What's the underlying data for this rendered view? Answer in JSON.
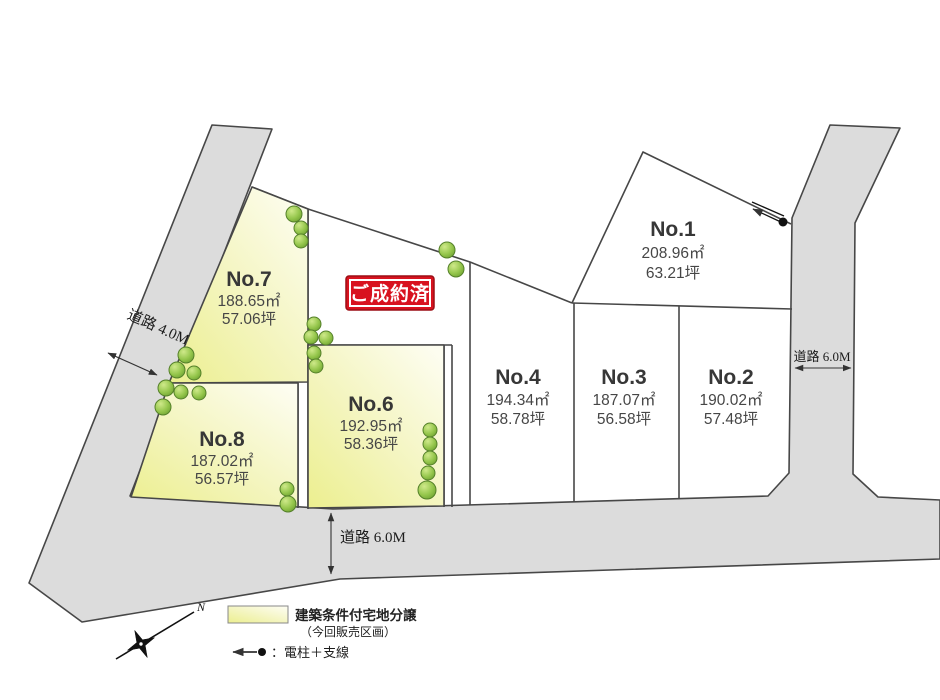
{
  "lots": [
    {
      "name": "No.1",
      "area": "208.96㎡",
      "tsubo": "63.21坪"
    },
    {
      "name": "No.2",
      "area": "190.02㎡",
      "tsubo": "57.48坪"
    },
    {
      "name": "No.3",
      "area": "187.07㎡",
      "tsubo": "56.58坪"
    },
    {
      "name": "No.4",
      "area": "194.34㎡",
      "tsubo": "58.78坪"
    },
    {
      "name": "No.6",
      "area": "192.95㎡",
      "tsubo": "58.36坪"
    },
    {
      "name": "No.7",
      "area": "188.65㎡",
      "tsubo": "57.06坪"
    },
    {
      "name": "No.8",
      "area": "187.02㎡",
      "tsubo": "56.57坪"
    }
  ],
  "badge": {
    "sold": "ご成約済"
  },
  "roads": {
    "left_width": "道路 4.0M",
    "right_width": "道路 6.0M",
    "bottom_width": "道路 6.0M"
  },
  "legend": {
    "swatch_label": "建築条件付宅地分譲",
    "swatch_note": "（今回販売区画）",
    "pole_label": "：電柱＋支線"
  },
  "compass": {
    "north": "N"
  },
  "colors": {
    "road_gray": "#dcdcdc",
    "lot_yellow": "#edf096",
    "badge_red": "#d8121f",
    "tree_green": "#86bb3e",
    "line": "#474747"
  }
}
